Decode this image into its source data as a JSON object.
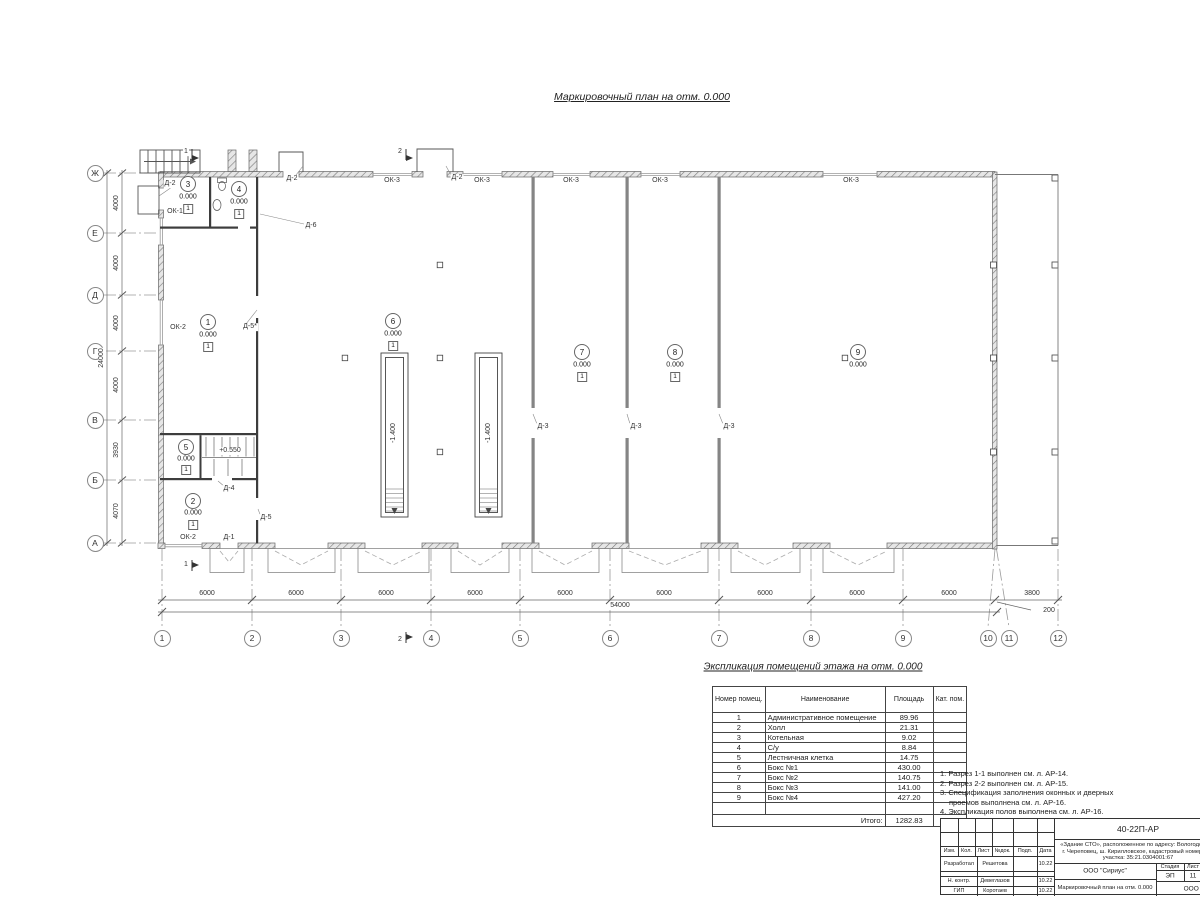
{
  "sheet": {
    "title": "Маркировочный план на отм. 0.000"
  },
  "axes_rows": [
    {
      "label": "Ж"
    },
    {
      "label": "Е"
    },
    {
      "label": "Д"
    },
    {
      "label": "Г"
    },
    {
      "label": "В"
    },
    {
      "label": "Б"
    },
    {
      "label": "А"
    }
  ],
  "axes_cols": [
    {
      "label": "1"
    },
    {
      "label": "2"
    },
    {
      "label": "3"
    },
    {
      "label": "4"
    },
    {
      "label": "5"
    },
    {
      "label": "6"
    },
    {
      "label": "7"
    },
    {
      "label": "8"
    },
    {
      "label": "9"
    },
    {
      "label": "10"
    },
    {
      "label": "11"
    },
    {
      "label": "12"
    }
  ],
  "dims": {
    "v": [
      {
        "v": "4000"
      },
      {
        "v": "4000"
      },
      {
        "v": "4000"
      },
      {
        "v": "4000"
      },
      {
        "v": "3930"
      },
      {
        "v": "4070"
      }
    ],
    "v_total": "24000",
    "h": [
      {
        "v": "6000"
      },
      {
        "v": "6000"
      },
      {
        "v": "6000"
      },
      {
        "v": "6000"
      },
      {
        "v": "6000"
      },
      {
        "v": "6000"
      },
      {
        "v": "6000"
      },
      {
        "v": "6000"
      },
      {
        "v": "6000"
      }
    ],
    "h_small": "200",
    "h_right": "3800",
    "h_total": "54000"
  },
  "rooms": [
    {
      "num": "1",
      "elev": "0.000",
      "floor": "1"
    },
    {
      "num": "2",
      "elev": "0.000",
      "floor": "1"
    },
    {
      "num": "3",
      "elev": "0.000",
      "floor": "1"
    },
    {
      "num": "4",
      "elev": "0.000",
      "floor": "1"
    },
    {
      "num": "5",
      "elev": "0.000",
      "floor": "1"
    },
    {
      "num": "6",
      "elev": "0.000",
      "floor": "1"
    },
    {
      "num": "7",
      "elev": "0.000",
      "floor": "1"
    },
    {
      "num": "8",
      "elev": "0.000",
      "floor": "1"
    },
    {
      "num": "9",
      "elev": "0.000"
    }
  ],
  "marks": {
    "ok1": "ОК-1",
    "ok2_left": "ОК-2",
    "ok2_bottom": "ОК-2",
    "ok3": [
      {
        "v": "ОК-3"
      },
      {
        "v": "ОК-3"
      },
      {
        "v": "ОК-3"
      },
      {
        "v": "ОК-3"
      },
      {
        "v": "ОК-3"
      }
    ],
    "d1": "Д-1",
    "d2_porch": "Д-2",
    "d2_t1": "Д-2",
    "d2_t2": "Д-2",
    "d3": [
      {
        "v": "Д-3"
      },
      {
        "v": "Д-3"
      },
      {
        "v": "Д-3"
      }
    ],
    "d4": "Д-4",
    "d5": "Д-5",
    "d5s": "Д-5*",
    "d6": "Д-6",
    "pit_depth": "-1.400",
    "stair_elev": "+0.550",
    "sec1": "1",
    "sec2": "2"
  },
  "explication": {
    "title": "Экспликация помещений этажа на отм. 0.000",
    "col_num": "Номер помещ.",
    "col_name": "Наименование",
    "col_area": "Площадь",
    "col_cat": "Кат. пом.",
    "rows": [
      {
        "num": "1",
        "name": "Административное помещение",
        "area": "89.96"
      },
      {
        "num": "2",
        "name": "Холл",
        "area": "21.31"
      },
      {
        "num": "3",
        "name": "Котельная",
        "area": "9.02"
      },
      {
        "num": "4",
        "name": "С/у",
        "area": "8.84"
      },
      {
        "num": "5",
        "name": "Лестничная клетка",
        "area": "14.75"
      },
      {
        "num": "6",
        "name": "Бокс №1",
        "area": "430.00"
      },
      {
        "num": "7",
        "name": "Бокс №2",
        "area": "140.75"
      },
      {
        "num": "8",
        "name": "Бокс №3",
        "area": "141.00"
      },
      {
        "num": "9",
        "name": "Бокс №4",
        "area": "427.20"
      }
    ],
    "total_label": "Итого:",
    "total": "1282.83"
  },
  "notes": {
    "l1": "1. Разрез 1-1 выполнен см. л. АР-14.",
    "l2": "2. Разрез 2-2 выполнен см. л. АР-15.",
    "l3": "3. Спецификация заполнения оконных и дверных",
    "l4": "проемов выполнена см. л. АР-16.",
    "l5": "4. Экспликация полов выполнена см. л. АР-16."
  },
  "titleblock": {
    "code": "40-22П-АР",
    "desc1": "«Здание СТО», расположенное по адресу: Вологодская о",
    "desc2": "г. Череповец, ш. Кирилловское, кадастровый номер зем",
    "desc3": "участка: 35:21.0304001:67",
    "h_izm": "Изм.",
    "h_kol": "Кол.",
    "h_list": "Лист",
    "h_doc": "№док.",
    "h_sign": "Подп.",
    "h_date": "Дата",
    "r1_role": "Разработал",
    "r1_name": "Решетова",
    "r1_date": "10.22",
    "r2_role": "Н. контр.",
    "r2_name": "Девеглазов",
    "r2_date": "10.22",
    "r3_role": "ГИП",
    "r3_name": "Коротаев",
    "r3_date": "10.22",
    "org": "ООО \"Сириус\"",
    "stage_label": "Стадия",
    "list_label": "Лист",
    "stage": "ЭП",
    "list_num": "11",
    "doc_title": "Маркировочный план на отм. 0.000",
    "org2": "ООО \"Аль"
  }
}
